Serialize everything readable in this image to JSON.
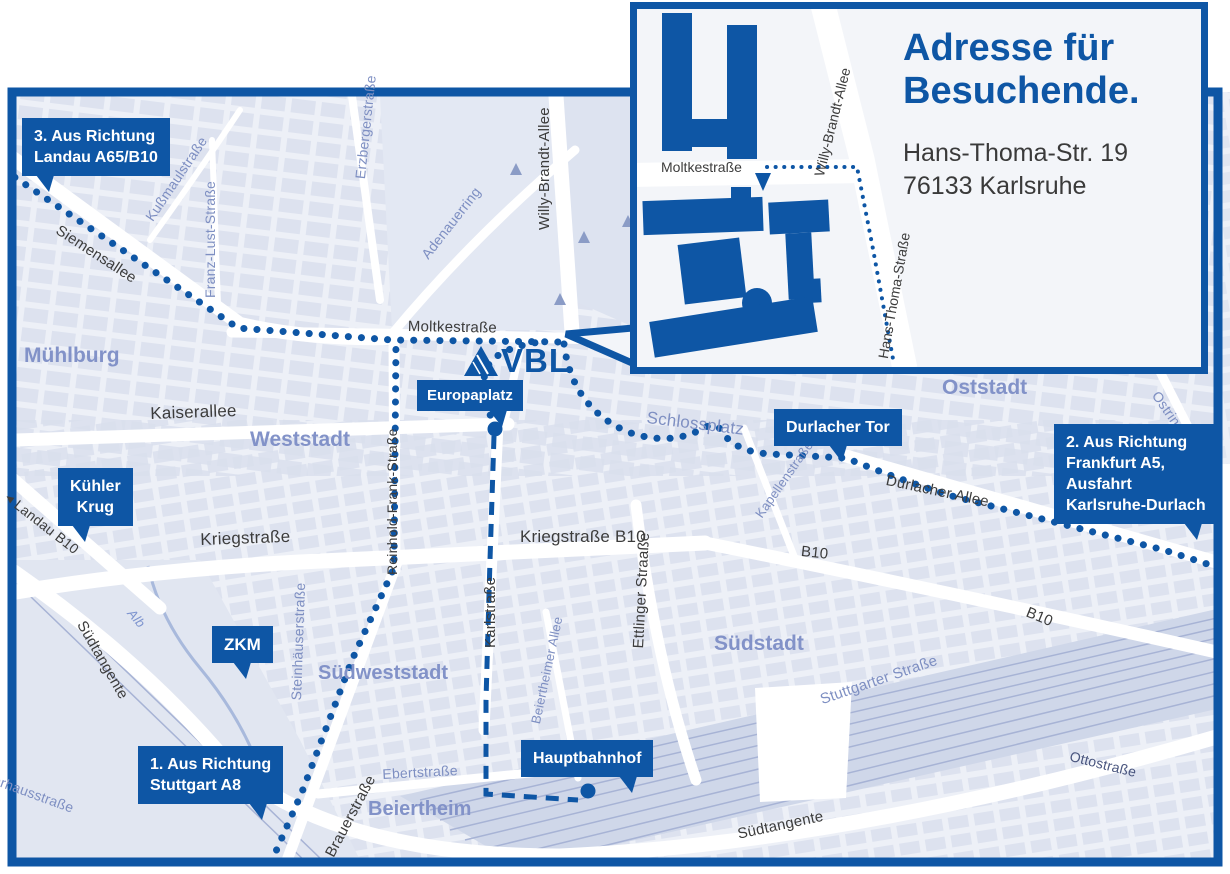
{
  "map": {
    "logo": "VBL",
    "badges": {
      "route3": [
        "3. Aus Richtung",
        "Landau A65/B10"
      ],
      "route2": [
        "2. Aus Richtung",
        "Frankfurt A5,",
        "Ausfahrt",
        "Karlsruhe-Durlach"
      ],
      "route1": [
        "1. Aus Richtung",
        "Stuttgart A8"
      ],
      "kuehler_krug": [
        "Kühler",
        "Krug"
      ],
      "zkm": "ZKM",
      "europaplatz": "Europaplatz",
      "durlacher_tor": "Durlacher Tor",
      "hauptbahnhof": "Hauptbahnhof"
    },
    "districts": {
      "muehlburg": "Mühlburg",
      "weststadt": "Weststadt",
      "oststadt": "Oststadt",
      "suedstadt": "Südstadt",
      "suedweststadt": "Südweststadt",
      "beiertheim": "Beiertheim"
    },
    "streets": {
      "siemensallee": "Siemensallee",
      "kussmaulstrasse": "Kußmaulstraße",
      "franz_lust_strasse": "Franz-Lust-Straße",
      "erzbergerstrasse": "Erzbergerstraße",
      "adenauerring": "Adenauerring",
      "willy_brandt_allee": "Willy-Brandt-Allee",
      "moltkestrasse": "Moltkestraße",
      "kaiserallee": "Kaiserallee",
      "reinhold_frank_strasse": "Reinhold-Frank-Straße",
      "kriegstrasse": "Kriegstraße",
      "kriegstrasse_b10": "Kriegstraße B10",
      "karlstrasse": "Karlstraße",
      "ettlinger_strasse": "Ettlinger Straaße",
      "schlossplatz": "Schlossplatz",
      "durlacher_allee": "Durlacher Allee",
      "kapellenstrasse": "Kapellenstraße",
      "ostring": "Ostring",
      "b10_south": "B10",
      "b10_east": "B10",
      "landau_b10": "Landau B10",
      "steinhaeuserstrasse": "Steinhäuserstraße",
      "brauerstrasse": "Brauerstraße",
      "ebertstrasse": "Ebertstraße",
      "beiertheimer_allee": "Beiertheimer Allee",
      "stuttgarter_strasse": "Stuttgarter Straße",
      "suedtangente_left": "Südtangente",
      "suedtangente_bottom": "Südtangente",
      "alb": "Alb",
      "pulverhausstrasse": "Pulverhausstraße",
      "ottostrasse": "Ottostraße"
    },
    "icons": {
      "left_arrow": "◄"
    }
  },
  "inset": {
    "title": "Adresse für Besuchende.",
    "address": [
      "Hans-Thoma-Str. 19",
      "76133 Karlsruhe"
    ],
    "streets": {
      "moltkestrasse": "Moltkestraße",
      "willy_brandt_allee": "Willy-Brandt-Allee",
      "hans_thoma_strasse": "Hans-Thoma-Straße"
    }
  },
  "colors": {
    "accent": "#0e56a5",
    "street_dark": "#3c3c3c",
    "street_muted": "#7e8fc2",
    "district": "#8292c8",
    "road": "#ffffff",
    "map_background": "#edf0f7",
    "city_block": "#d9dfed",
    "rail": "#a7b3d5"
  }
}
